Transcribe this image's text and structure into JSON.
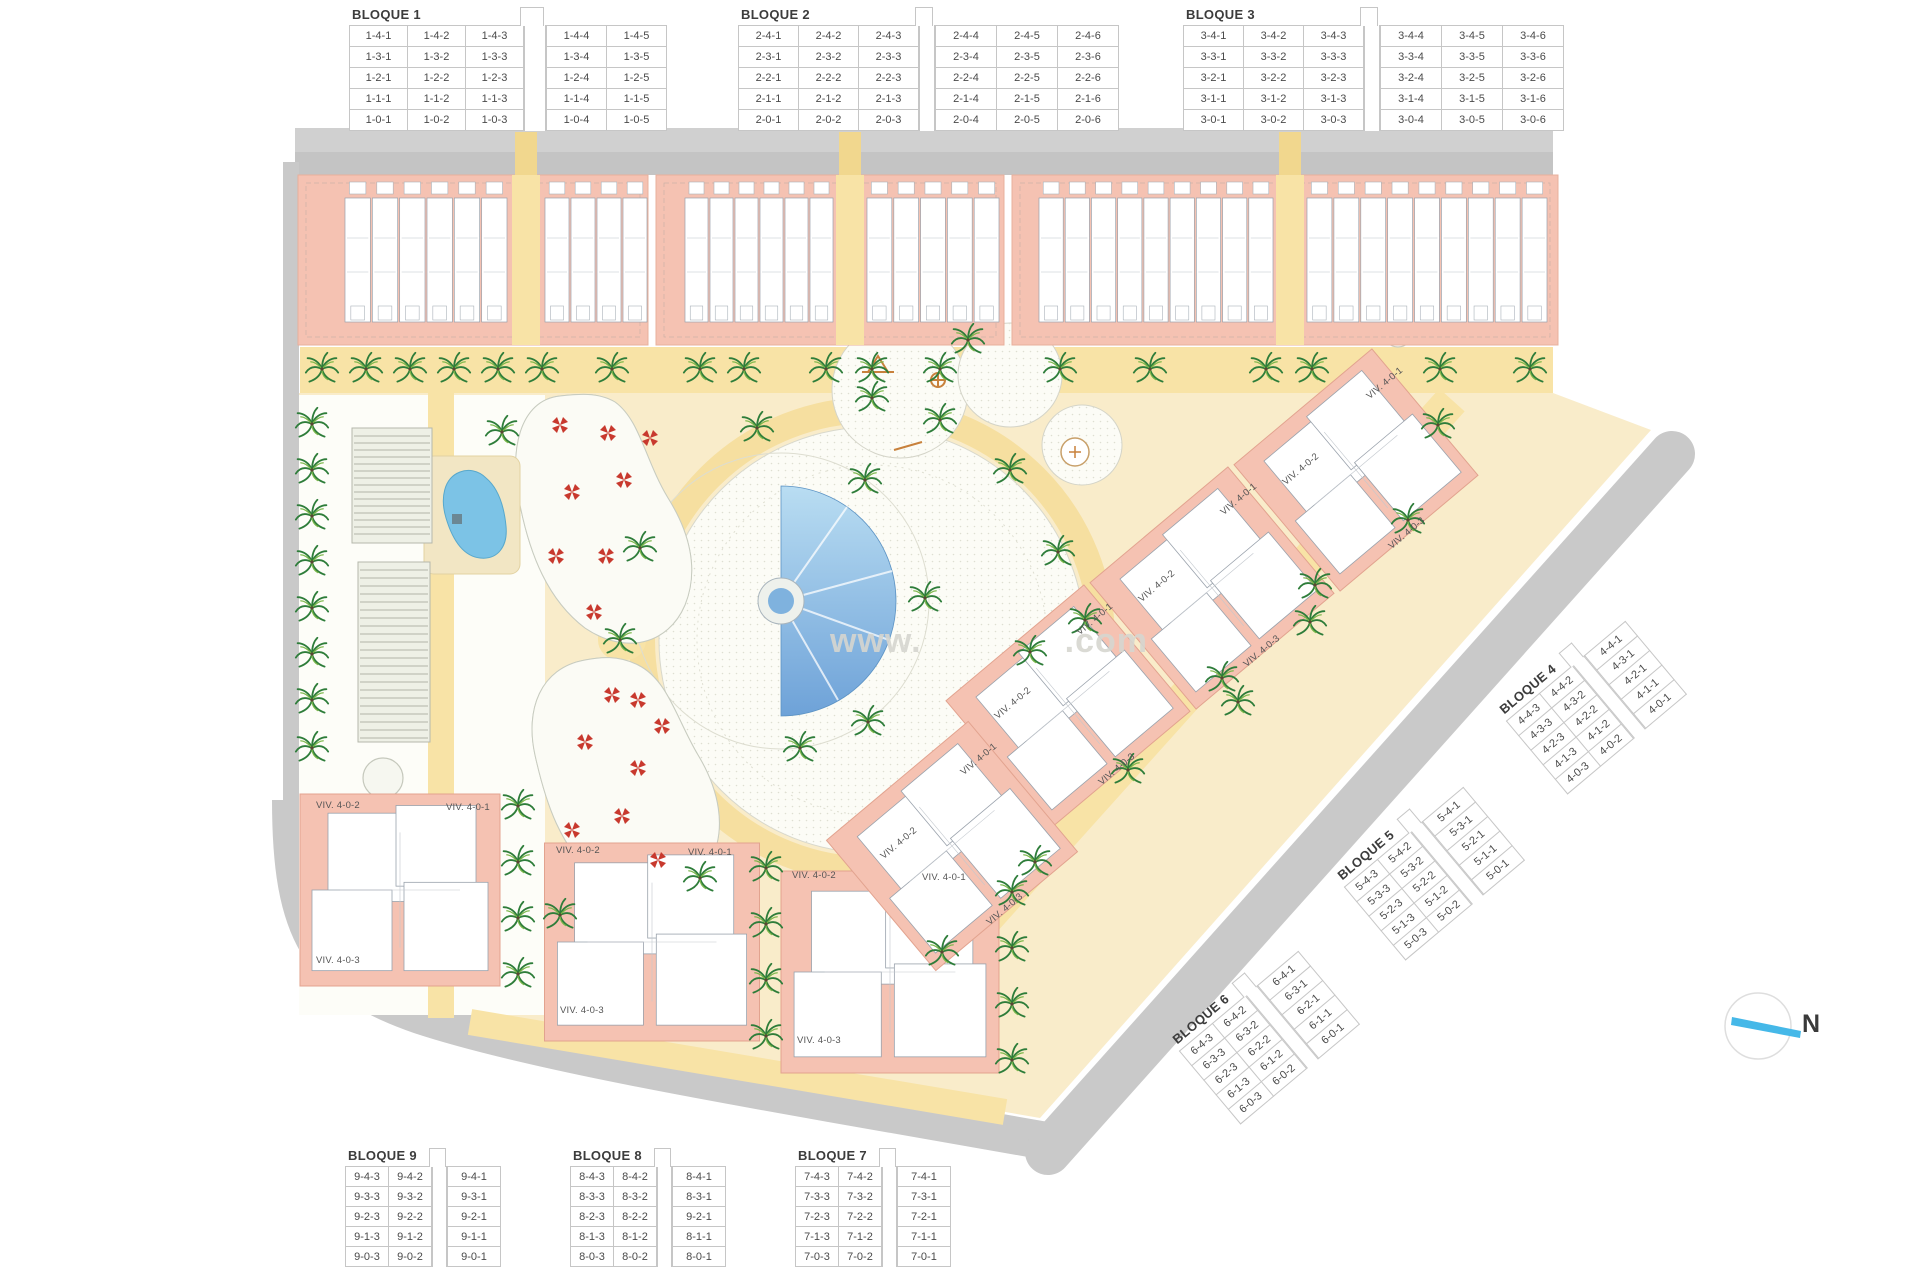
{
  "plan": {
    "watermark_left": "www.",
    "watermark_right": ".com",
    "compass_label": "N"
  },
  "colors": {
    "road_gray": "#c9c9c9",
    "building_salmon": "#f5c2b2",
    "path_yellow": "#f8e3a6",
    "sand": "#f9ecca",
    "pool_blue": "#7fb3e0",
    "palm_green": "#3f8f4f",
    "umbrella_red": "#c8392e",
    "compass_needle": "#45b8e8"
  },
  "unit_tables": [
    {
      "id": "b1",
      "title": "BLOQUE 1",
      "gap_after": 3,
      "rows": [
        [
          "1-4-1",
          "1-4-2",
          "1-4-3",
          "1-4-4",
          "1-4-5"
        ],
        [
          "1-3-1",
          "1-3-2",
          "1-3-3",
          "1-3-4",
          "1-3-5"
        ],
        [
          "1-2-1",
          "1-2-2",
          "1-2-3",
          "1-2-4",
          "1-2-5"
        ],
        [
          "1-1-1",
          "1-1-2",
          "1-1-3",
          "1-1-4",
          "1-1-5"
        ],
        [
          "1-0-1",
          "1-0-2",
          "1-0-3",
          "1-0-4",
          "1-0-5"
        ]
      ]
    },
    {
      "id": "b2",
      "title": "BLOQUE 2",
      "gap_after": 3,
      "rows": [
        [
          "2-4-1",
          "2-4-2",
          "2-4-3",
          "2-4-4",
          "2-4-5",
          "2-4-6"
        ],
        [
          "2-3-1",
          "2-3-2",
          "2-3-3",
          "2-3-4",
          "2-3-5",
          "2-3-6"
        ],
        [
          "2-2-1",
          "2-2-2",
          "2-2-3",
          "2-2-4",
          "2-2-5",
          "2-2-6"
        ],
        [
          "2-1-1",
          "2-1-2",
          "2-1-3",
          "2-1-4",
          "2-1-5",
          "2-1-6"
        ],
        [
          "2-0-1",
          "2-0-2",
          "2-0-3",
          "2-0-4",
          "2-0-5",
          "2-0-6"
        ]
      ]
    },
    {
      "id": "b3",
      "title": "BLOQUE 3",
      "gap_after": 3,
      "rows": [
        [
          "3-4-1",
          "3-4-2",
          "3-4-3",
          "3-4-4",
          "3-4-5",
          "3-4-6"
        ],
        [
          "3-3-1",
          "3-3-2",
          "3-3-3",
          "3-3-4",
          "3-3-5",
          "3-3-6"
        ],
        [
          "3-2-1",
          "3-2-2",
          "3-2-3",
          "3-2-4",
          "3-2-5",
          "3-2-6"
        ],
        [
          "3-1-1",
          "3-1-2",
          "3-1-3",
          "3-1-4",
          "3-1-5",
          "3-1-6"
        ],
        [
          "3-0-1",
          "3-0-2",
          "3-0-3",
          "3-0-4",
          "3-0-5",
          "3-0-6"
        ]
      ]
    },
    {
      "id": "b4",
      "title": "BLOQUE 4",
      "gap_after": 2,
      "rows": [
        [
          "4-4-3",
          "4-4-2",
          "4-4-1"
        ],
        [
          "4-3-3",
          "4-3-2",
          "4-3-1"
        ],
        [
          "4-2-3",
          "4-2-2",
          "4-2-1"
        ],
        [
          "4-1-3",
          "4-1-2",
          "4-1-1"
        ],
        [
          "4-0-3",
          "4-0-2",
          "4-0-1"
        ]
      ]
    },
    {
      "id": "b5",
      "title": "BLOQUE 5",
      "gap_after": 2,
      "rows": [
        [
          "5-4-3",
          "5-4-2",
          "5-4-1"
        ],
        [
          "5-3-3",
          "5-3-2",
          "5-3-1"
        ],
        [
          "5-2-3",
          "5-2-2",
          "5-2-1"
        ],
        [
          "5-1-3",
          "5-1-2",
          "5-1-1"
        ],
        [
          "5-0-3",
          "5-0-2",
          "5-0-1"
        ]
      ]
    },
    {
      "id": "b6",
      "title": "BLOQUE 6",
      "gap_after": 2,
      "rows": [
        [
          "6-4-3",
          "6-4-2",
          "6-4-1"
        ],
        [
          "6-3-3",
          "6-3-2",
          "6-3-1"
        ],
        [
          "6-2-3",
          "6-2-2",
          "6-2-1"
        ],
        [
          "6-1-3",
          "6-1-2",
          "6-1-1"
        ],
        [
          "6-0-3",
          "6-0-2",
          "6-0-1"
        ]
      ]
    },
    {
      "id": "b7",
      "title": "BLOQUE 7",
      "gap_after": 2,
      "rows": [
        [
          "7-4-3",
          "7-4-2",
          "7-4-1"
        ],
        [
          "7-3-3",
          "7-3-2",
          "7-3-1"
        ],
        [
          "7-2-3",
          "7-2-2",
          "7-2-1"
        ],
        [
          "7-1-3",
          "7-1-2",
          "7-1-1"
        ],
        [
          "7-0-3",
          "7-0-2",
          "7-0-1"
        ]
      ]
    },
    {
      "id": "b8",
      "title": "BLOQUE 8",
      "gap_after": 2,
      "rows": [
        [
          "8-4-3",
          "8-4-2",
          "8-4-1"
        ],
        [
          "8-3-3",
          "8-3-2",
          "8-3-1"
        ],
        [
          "8-2-3",
          "8-2-2",
          "9-2-1"
        ],
        [
          "8-1-3",
          "8-1-2",
          "8-1-1"
        ],
        [
          "8-0-3",
          "8-0-2",
          "8-0-1"
        ]
      ]
    },
    {
      "id": "b9",
      "title": "BLOQUE 9",
      "gap_after": 2,
      "rows": [
        [
          "9-4-3",
          "9-4-2",
          "9-4-1"
        ],
        [
          "9-3-3",
          "9-3-2",
          "9-3-1"
        ],
        [
          "9-2-3",
          "9-2-2",
          "9-2-1"
        ],
        [
          "9-1-3",
          "9-1-2",
          "9-1-1"
        ],
        [
          "9-0-3",
          "9-0-2",
          "9-0-1"
        ]
      ]
    }
  ],
  "viv_labels": [
    {
      "text": "VIV. 4-0-2",
      "x": 316,
      "y": 800,
      "rot": 0
    },
    {
      "text": "VIV. 4-0-1",
      "x": 446,
      "y": 802,
      "rot": 0
    },
    {
      "text": "VIV. 4-0-3",
      "x": 316,
      "y": 955,
      "rot": 0
    },
    {
      "text": "VIV. 4-0-2",
      "x": 556,
      "y": 845,
      "rot": 0
    },
    {
      "text": "VIV. 4-0-1",
      "x": 688,
      "y": 847,
      "rot": 0
    },
    {
      "text": "VIV. 4-0-3",
      "x": 560,
      "y": 1005,
      "rot": 0
    },
    {
      "text": "VIV. 4-0-2",
      "x": 792,
      "y": 870,
      "rot": 0
    },
    {
      "text": "VIV. 4-0-1",
      "x": 922,
      "y": 872,
      "rot": 0
    },
    {
      "text": "VIV. 4-0-3",
      "x": 797,
      "y": 1035,
      "rot": 0
    },
    {
      "text": "VIV. 4-0-1",
      "x": 1368,
      "y": 392,
      "rot": -40
    },
    {
      "text": "VIV. 4-0-2",
      "x": 1284,
      "y": 478,
      "rot": -40
    },
    {
      "text": "VIV. 4-0-3",
      "x": 1390,
      "y": 542,
      "rot": -40
    },
    {
      "text": "VIV. 4-0-1",
      "x": 1222,
      "y": 508,
      "rot": -40
    },
    {
      "text": "VIV. 4-0-2",
      "x": 1140,
      "y": 595,
      "rot": -40
    },
    {
      "text": "VIV. 4-0-3",
      "x": 1245,
      "y": 660,
      "rot": -40
    },
    {
      "text": "VIV. 4-0-1",
      "x": 1078,
      "y": 628,
      "rot": -40
    },
    {
      "text": "VIV. 4-0-2",
      "x": 996,
      "y": 712,
      "rot": -40
    },
    {
      "text": "VIV. 4-0-3",
      "x": 1100,
      "y": 778,
      "rot": -40
    },
    {
      "text": "VIV. 4-0-1",
      "x": 962,
      "y": 768,
      "rot": -40
    },
    {
      "text": "VIV. 4-0-2",
      "x": 882,
      "y": 852,
      "rot": -40
    },
    {
      "text": "VIV. 4-0-3",
      "x": 988,
      "y": 918,
      "rot": -40
    }
  ]
}
